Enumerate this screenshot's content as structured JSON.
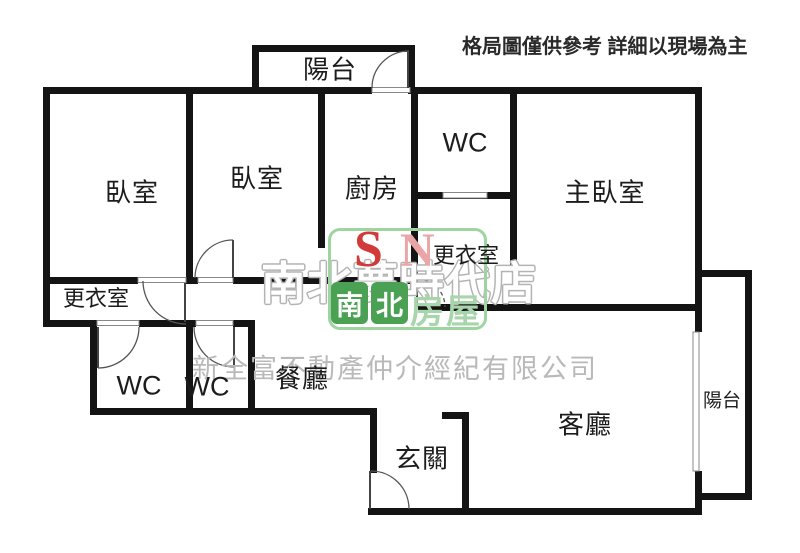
{
  "disclaimer": "格局圖僅供參考 詳細以現場為主",
  "rooms": {
    "balcony_top": "陽台",
    "bedroom_left": "臥室",
    "bedroom_mid": "臥室",
    "kitchen": "廚房",
    "wc_top": "WC",
    "master_bedroom": "主臥室",
    "closet_master": "更衣室",
    "closet_left": "更衣室",
    "wc_left": "WC",
    "wc_mid": "WC",
    "dining": "餐廳",
    "entry": "玄關",
    "living": "客廳",
    "balcony_right": "陽台"
  },
  "watermark": {
    "store_name": "南北夢時代店",
    "company_name": "新全富不動產仲介經紀有限公司"
  },
  "logo": {
    "letter_s": "S",
    "letter_n": "N",
    "brand_primary_1": "南",
    "brand_primary_2": "北",
    "brand_secondary": "房屋"
  },
  "colors": {
    "wall": "#141414",
    "door_line": "#555555",
    "disclaimer_text": "#2a2a2a",
    "watermark_gray": "#b3b3b3",
    "logo_red": "#d23a3a",
    "logo_pink": "#eaa6a6",
    "logo_green": "#9ed4a0",
    "logo_green_dark": "#4aa053"
  }
}
